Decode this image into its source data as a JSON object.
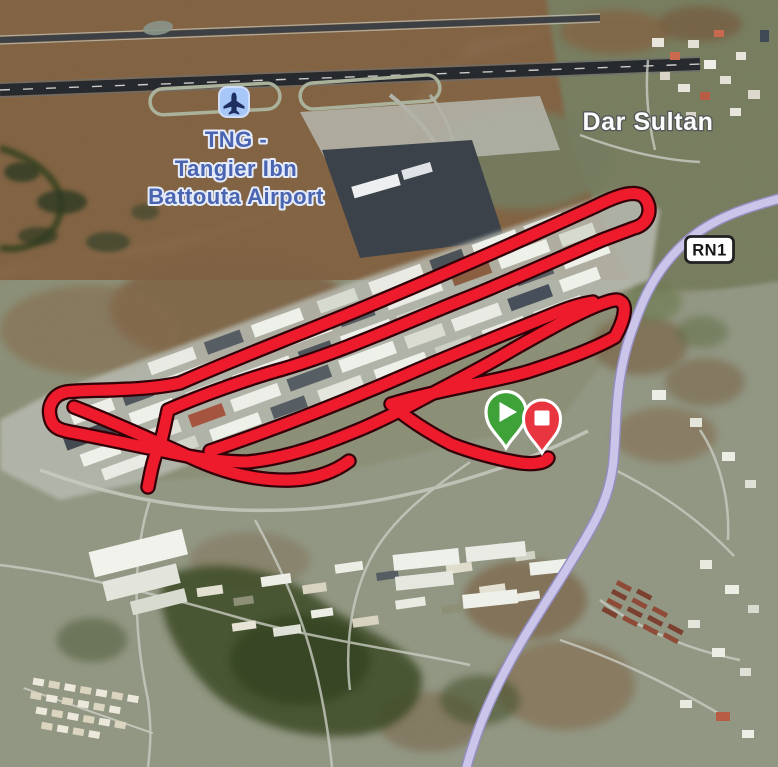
{
  "map": {
    "labels": {
      "airport": {
        "line1": "TNG -",
        "line2": "Tangier Ibn",
        "line3": "Battouta Airport",
        "icon": "airplane-icon",
        "text_color": "#4a64b0",
        "halo_color": "#e4ebfb",
        "icon_bg_color": "#a7c7f9",
        "icon_glyph_color": "#1e2e5e"
      },
      "place": {
        "text": "Dar Sultan",
        "text_color": "#fdfdfd",
        "halo_color": "#54585a"
      },
      "road_badge": {
        "text": "RN1",
        "bg_color": "#ffffff",
        "border_color": "#202020",
        "text_color": "#161616"
      }
    },
    "route": {
      "color": "#ee1b2c",
      "outline_color": "#320007"
    },
    "road": {
      "badge": "RN1",
      "fill_color": "#cbc6e9",
      "casing_color": "#938dc0"
    },
    "markers": {
      "start": {
        "icon": "play-icon",
        "color": "#3ea239",
        "border_color": "#ffffff"
      },
      "end": {
        "icon": "stop-icon",
        "color": "#e93540",
        "border_color": "#ffffff"
      }
    }
  }
}
